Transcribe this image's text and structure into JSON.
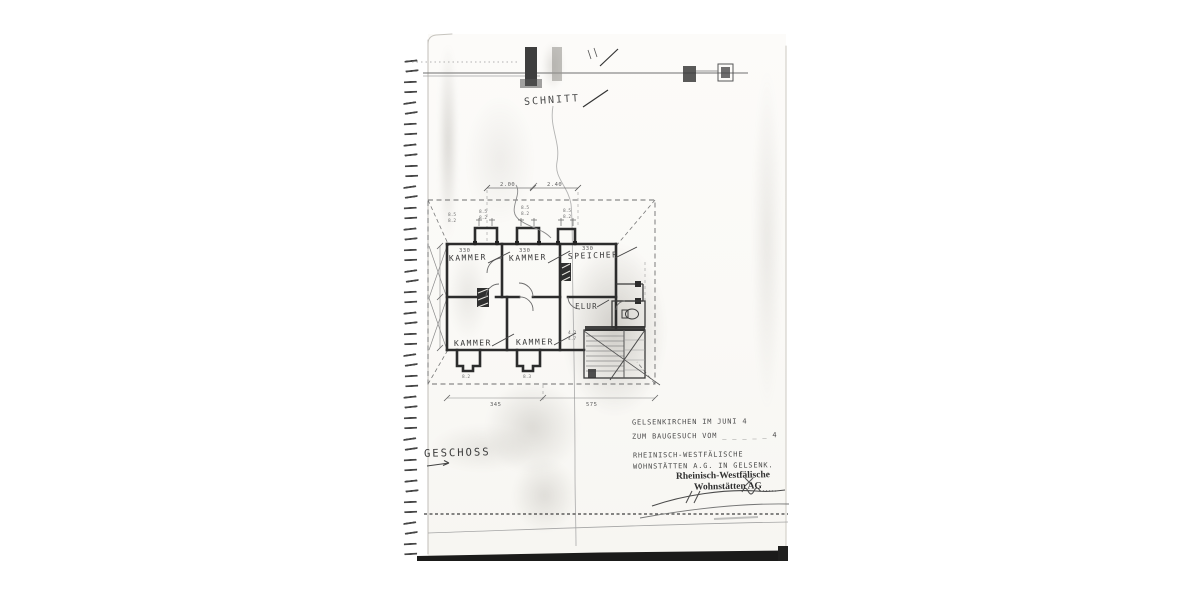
{
  "colors": {
    "paper": "#fbfaf7",
    "ink": "#3a3a3a",
    "wall_fill": "#2c2c2c",
    "shadow_bar": "#1b1b1a"
  },
  "annotations": {
    "section_label": "SCHNITT",
    "floor_label": "GESCHOSS"
  },
  "plan": {
    "rooms": {
      "top": [
        {
          "name": "KAMMER",
          "dim": "330"
        },
        {
          "name": "KAMMER",
          "dim": "330"
        },
        {
          "name": "SPEICHER",
          "dim": "330"
        }
      ],
      "bottom": [
        {
          "name": "KAMMER"
        },
        {
          "name": "KAMMER"
        },
        {
          "name": "FLUR"
        }
      ]
    },
    "dimensions": {
      "top_left": "2.00",
      "top_right": "2.40",
      "bottom_left": "345",
      "bottom_right": "575",
      "stack1a": "8.5",
      "stack1b": "8.2",
      "stack2a": "8.5",
      "stack2b": "8.2",
      "stack3a": "8.5",
      "stack3b": "8.2",
      "stack4a": "8.5",
      "stack4b": "8.2",
      "dormer1": "8.2",
      "dormer2": "8.3",
      "stair_a": "4.2",
      "stair_b": "4.7"
    }
  },
  "title_block": {
    "date_line": "GELSENKIRCHEN IM JUNI 4",
    "request_line": "ZUM BAUGESUCH VOM _ _ _ _ _ 4",
    "company_line1": "RHEINISCH-WESTFÄLISCHE",
    "company_line2": "WOHNSTÄTTEN A.G. IN GELSENK.",
    "stamp_line1": "Rheinisch-Westfälische",
    "stamp_line2": "Wohnstätten AG"
  }
}
